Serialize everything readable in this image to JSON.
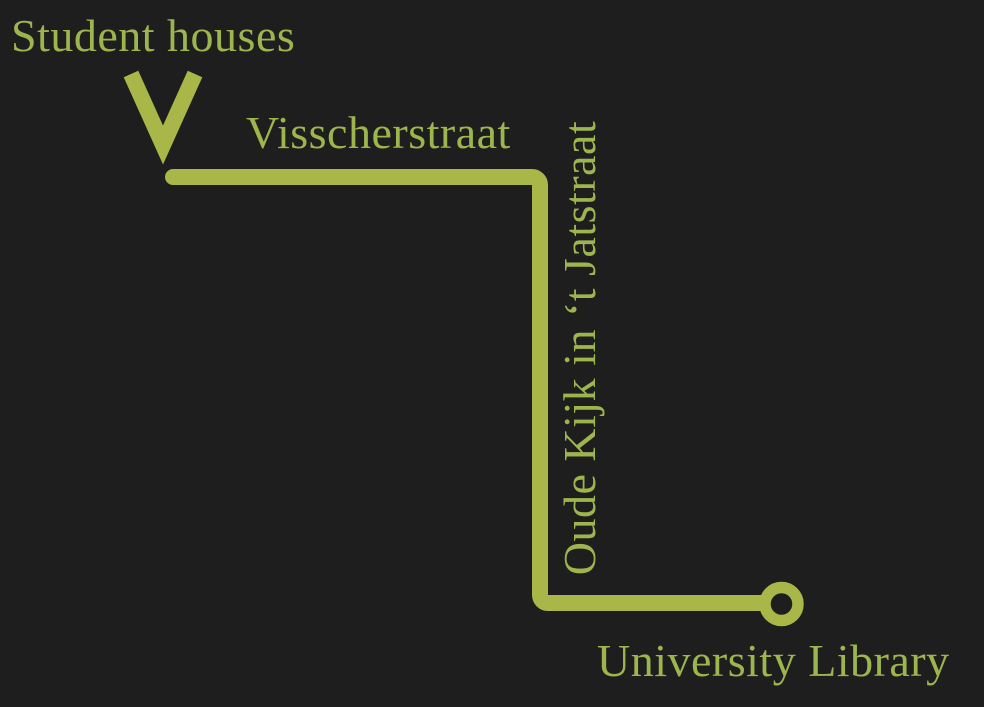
{
  "canvas": {
    "width": 984,
    "height": 707,
    "background": "#1f1e1e"
  },
  "colors": {
    "route": "#a8b748",
    "label": "#9db54d"
  },
  "labels": {
    "start": "Student houses",
    "street_horizontal": "Visscherstraat",
    "street_vertical": "Oude Kijk in ‘t Jatstraat",
    "end": "University Library"
  },
  "icons": {
    "start_marker": "double-chevron-down-icon",
    "end_marker": "ring-marker-icon"
  }
}
